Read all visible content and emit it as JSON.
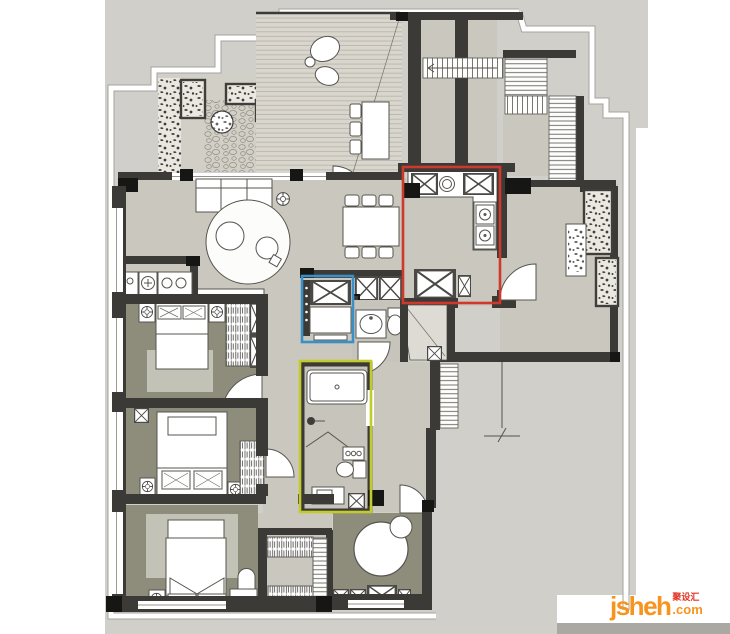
{
  "meta": {
    "title": "Apartment floor plan",
    "description": "Top-view architectural floor plan with three colored highlight boxes"
  },
  "palette": {
    "site": "#d0cfca",
    "floor": "#cac7bf",
    "bedroom": "#8e8d7c",
    "bath": "#c7c4bc",
    "wall": "#3b3a36",
    "deck": "#d9d6cd"
  },
  "highlights": [
    {
      "id": "kitchen-highlight-box",
      "color": "#cf382c",
      "x": 403,
      "y": 167,
      "w": 97,
      "h": 136
    },
    {
      "id": "cabinet-highlight-box",
      "color": "#3a8fc8",
      "x": 302,
      "y": 276,
      "w": 51,
      "h": 66
    },
    {
      "id": "bathroom-highlight-box",
      "color": "#c2cb2a",
      "x": 300,
      "y": 361,
      "w": 71,
      "h": 151
    }
  ],
  "watermark": {
    "brand": "jsheh",
    "cjk": "聚设汇",
    "tld": ".com",
    "orange": "#f7941e",
    "red": "#e03325",
    "bar": "#a9a8a3"
  }
}
